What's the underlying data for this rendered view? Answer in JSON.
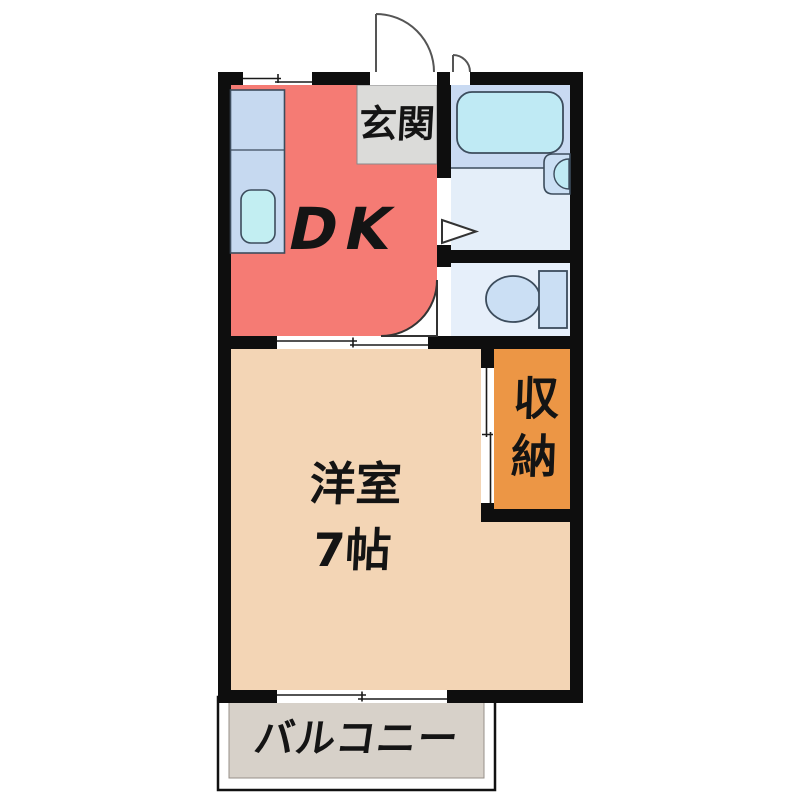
{
  "plan": {
    "type": "apartment-floor-plan",
    "labels": {
      "entrance": "玄関",
      "dining_kitchen": "DK",
      "western_room": "洋室",
      "western_room_size": "7帖",
      "storage": "収納",
      "balcony": "バルコニー"
    },
    "colors": {
      "wall": "#0E0E0E",
      "dk_floor": "#F57B74",
      "entrance_floor": "#DBDBD9",
      "western_room_floor": "#F3D5B5",
      "storage_floor": "#EC9645",
      "balcony_floor": "#D7D1C9",
      "bath_floor": "#C9DAF2",
      "washroom_floor": "#E4EEF9",
      "toilet_floor": "#E6EFFA",
      "bathtub": "#BFEAF4",
      "kitchen_counter": "#C6D9F0",
      "kitchen_sink": "#C2EEF2",
      "fixture_fill": "#CBDFF4",
      "fixture_stroke": "#3C4C5C",
      "door_arc": "#555555",
      "background": "#FFFFFF"
    }
  }
}
